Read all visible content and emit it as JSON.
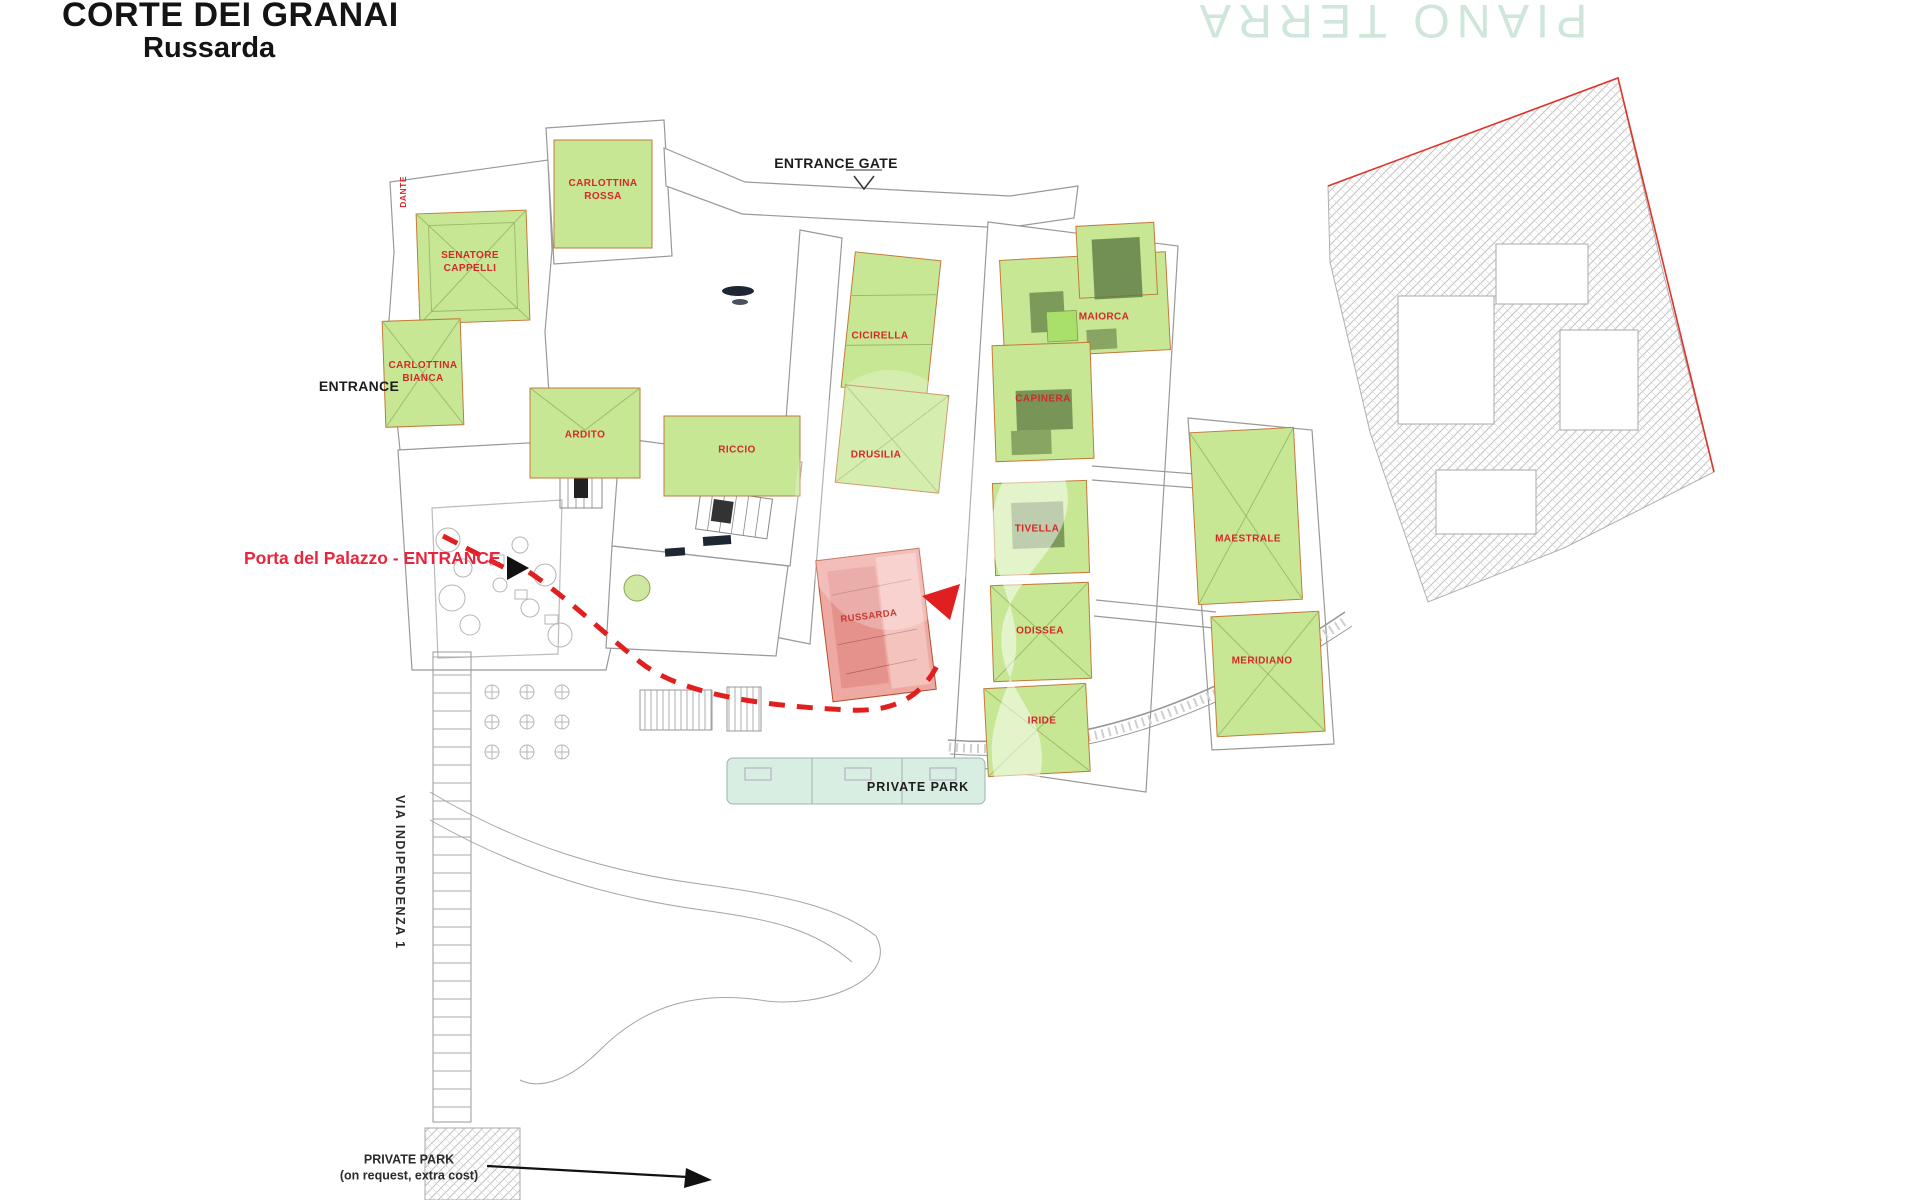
{
  "header": {
    "title": "CORTE DEI GRANAI",
    "subtitle": "Russarda"
  },
  "floor_watermark": "PIANO TERRA",
  "labels": {
    "entrance_gate": "ENTRANCE GATE",
    "entrance": "ENTRANCE",
    "palace_door": "Porta del Palazzo - ENTRANCE",
    "private_park": "PRIVATE PARK",
    "private_park_option_line1": "PRIVATE PARK",
    "private_park_option_line2": "(on request, extra cost)",
    "street": "VIA INDIPENDENZA 1",
    "street_small": "DANTE"
  },
  "apartments": [
    {
      "name": "CARLOTTINA ROSSA"
    },
    {
      "name": "SENATORE CAPPELLI"
    },
    {
      "name": "CARLOTTINA BIANCA"
    },
    {
      "name": "ARDITO"
    },
    {
      "name": "RICCIO"
    },
    {
      "name": "CICIRELLA"
    },
    {
      "name": "DRUSILIA"
    },
    {
      "name": "MAIORCA"
    },
    {
      "name": "CAPINERA"
    },
    {
      "name": "TIVELLA"
    },
    {
      "name": "ODISSEA"
    },
    {
      "name": "IRIDE"
    },
    {
      "name": "MAESTRALE"
    },
    {
      "name": "MERIDIANO"
    }
  ],
  "highlighted_unit": {
    "name": "RUSSARDA"
  },
  "colors": {
    "available_unit_fill": "#c7e795",
    "available_unit_border": "#c4793a",
    "highlight_unit_fill": "#efa9a3",
    "unit_label": "#d62828",
    "route_red": "#e02020",
    "floor_watermark": "#cfe6da",
    "ruin_outline": "#e03428",
    "linework": "#999999"
  }
}
